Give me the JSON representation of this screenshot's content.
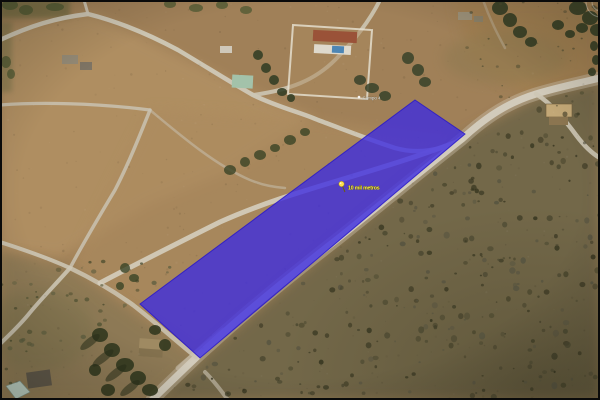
{
  "view": {
    "type": "aerial-satellite-view",
    "border_color": "#0a0a0a"
  },
  "parcel": {
    "label": "10 mil metros",
    "polygon_points": "415,100 465,134 200,358 140,304",
    "fill_color": "#3b2ae2",
    "fill_opacity": "0.78",
    "stroke_color": "#2817c9",
    "pushpin_color": "#ffe14d",
    "label_color": "#fdf44a"
  },
  "place_label": {
    "text": "Campo 4",
    "color": "#ffffff"
  },
  "controls": {
    "compass_color": "#ffffff"
  }
}
